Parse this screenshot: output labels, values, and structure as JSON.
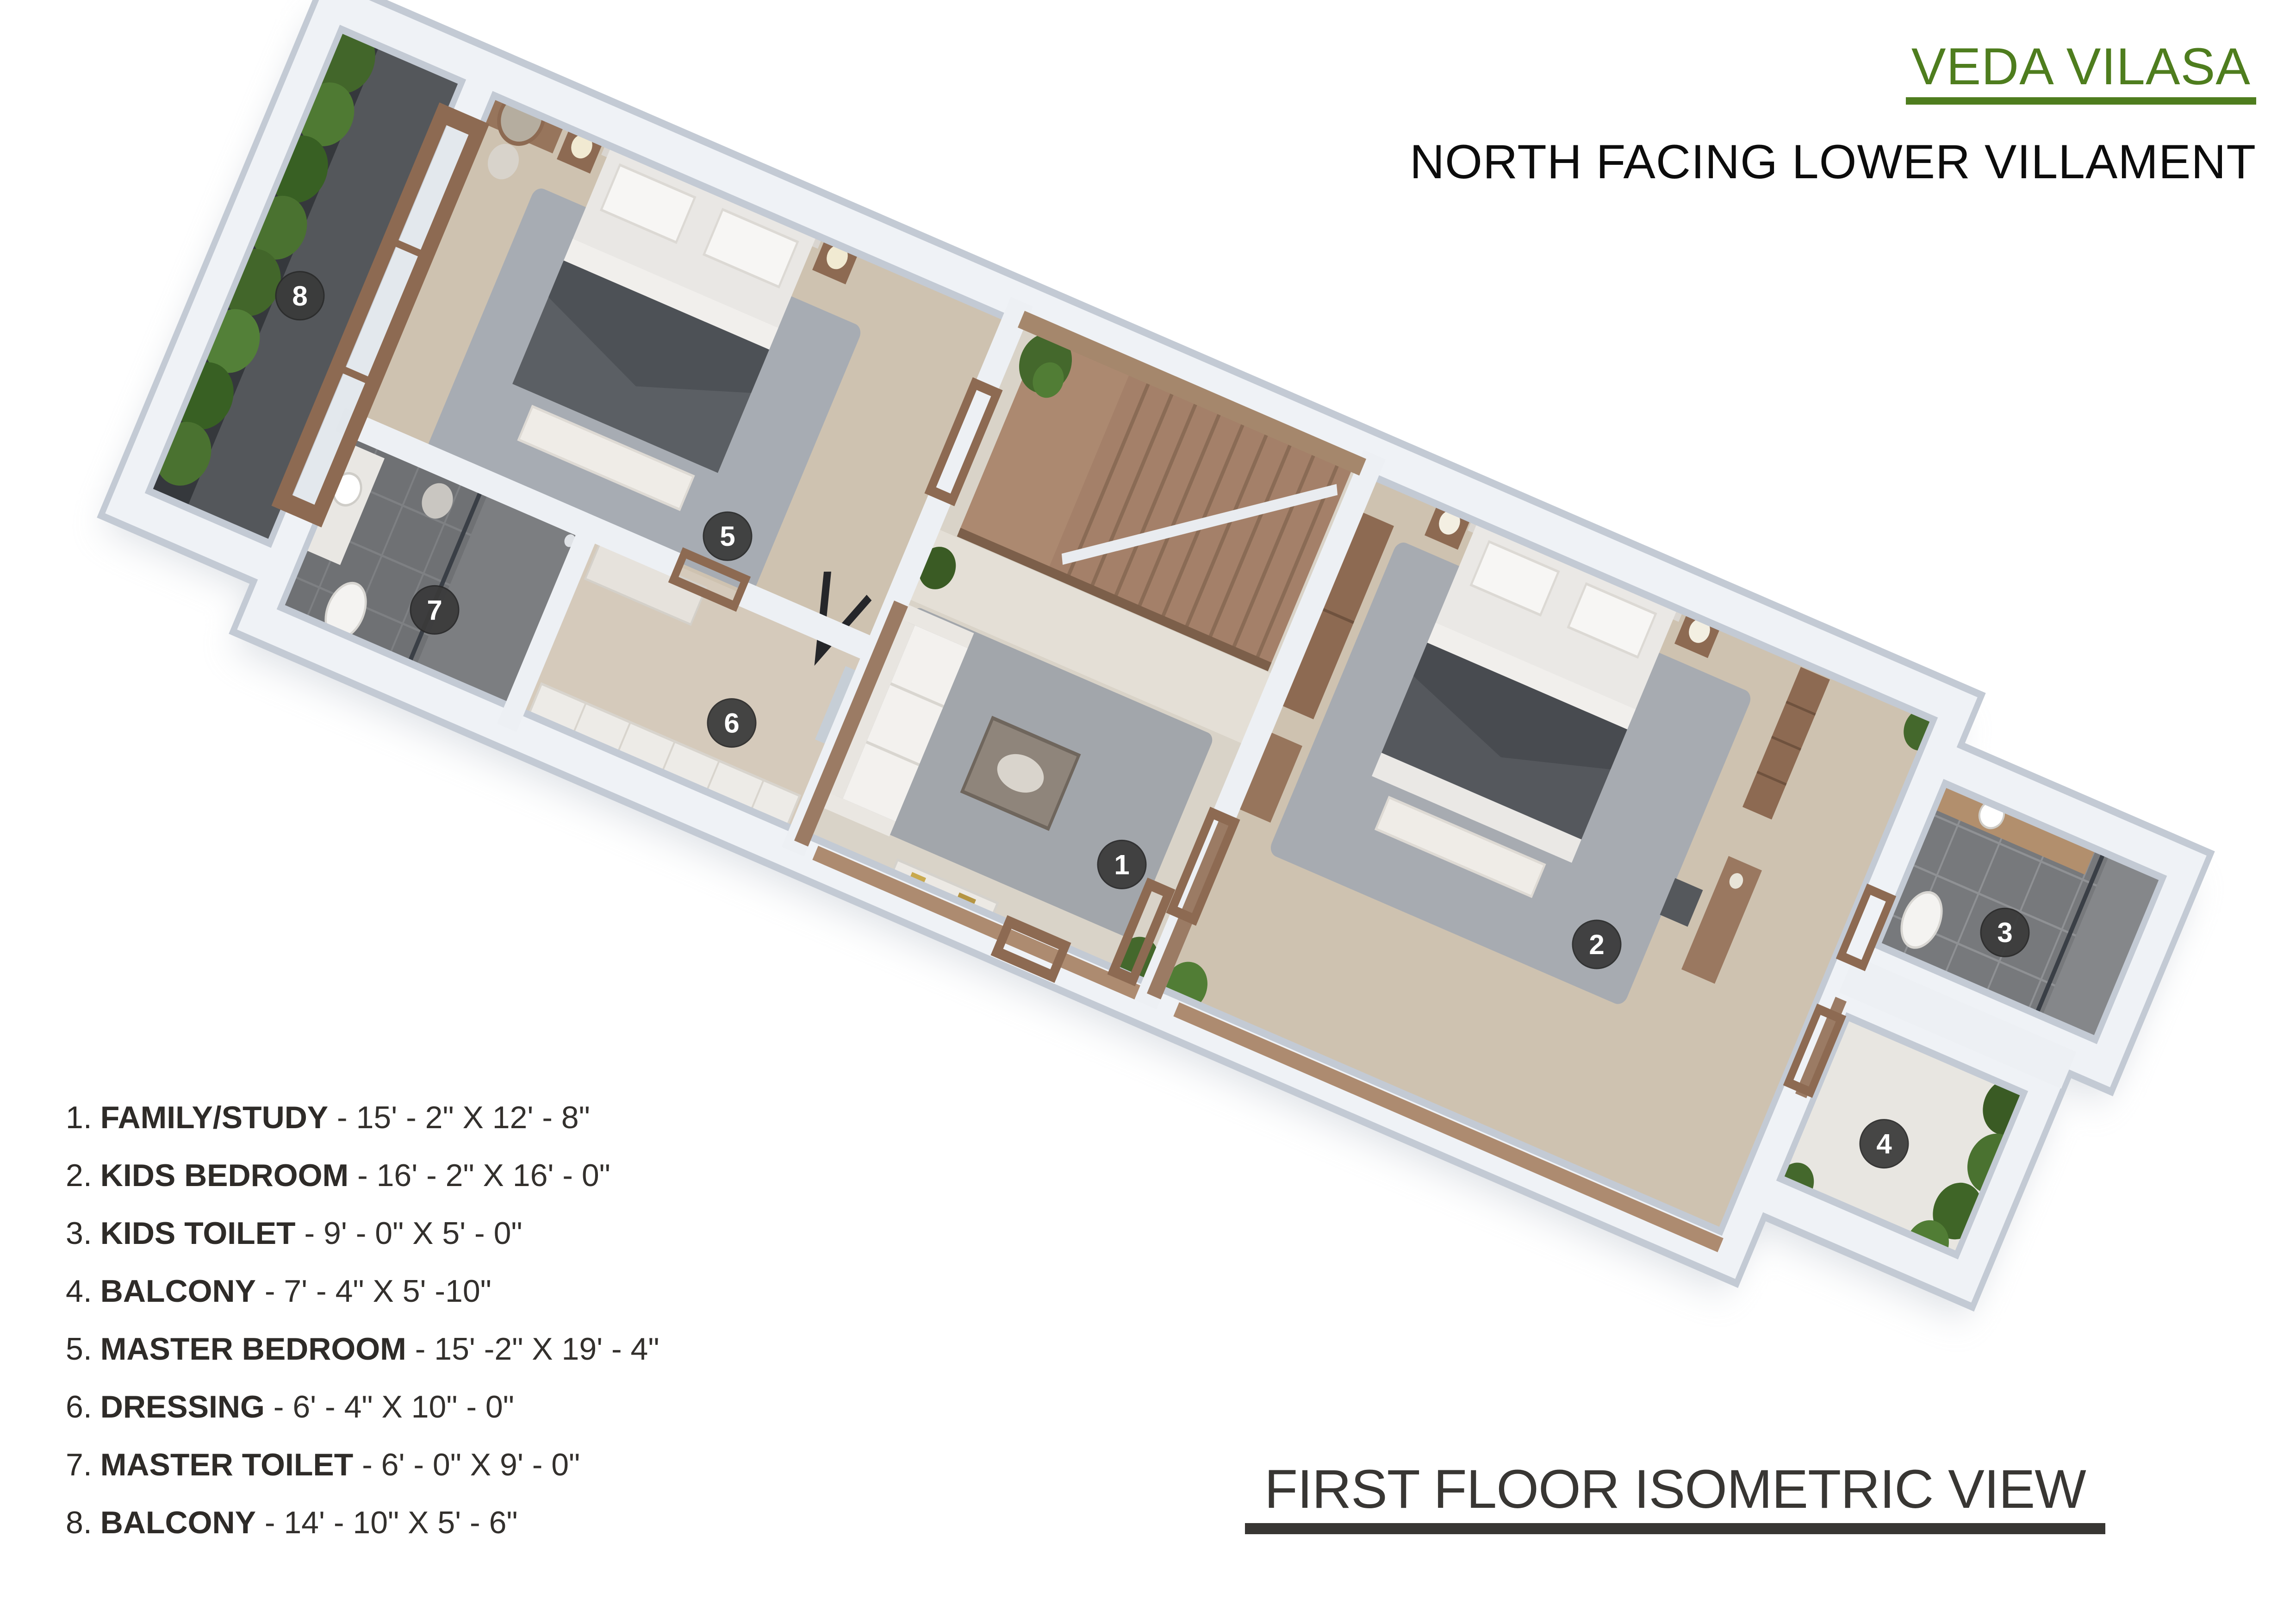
{
  "header": {
    "title": "VEDA VILASA",
    "subtitle": "NORTH FACING LOWER VILLAMENT",
    "title_color": "#4e7d1e"
  },
  "caption": {
    "text": "FIRST FLOOR ISOMETRIC VIEW"
  },
  "legend": {
    "items": [
      {
        "num": "1.",
        "name": "FAMILY/STUDY",
        "dims": "- 15' - 2\" X 12' - 8\""
      },
      {
        "num": "2.",
        "name": "KIDS BEDROOM",
        "dims": "- 16' - 2\" X 16' - 0\""
      },
      {
        "num": "3.",
        "name": "KIDS TOILET",
        "dims": "- 9' - 0\" X 5' - 0\""
      },
      {
        "num": "4.",
        "name": "BALCONY",
        "dims": "- 7' - 4\" X 5' -10\""
      },
      {
        "num": "5.",
        "name": "MASTER BEDROOM",
        "dims": "- 15' -2\" X 19' - 4\""
      },
      {
        "num": "6.",
        "name": "DRESSING",
        "dims": "- 6' - 4\" X 10\" - 0\""
      },
      {
        "num": "7.",
        "name": "MASTER TOILET",
        "dims": "- 6' - 0\" X 9' - 0\""
      },
      {
        "num": "8.",
        "name": "BALCONY",
        "dims": "- 14' - 10\" X 5' - 6\""
      }
    ]
  },
  "plan": {
    "marker_color": "#3a3a3a",
    "marker_text_color": "#ffffff",
    "markers": [
      {
        "label": "1",
        "u": 29.5,
        "v": 13.2
      },
      {
        "label": "2",
        "u": 45.0,
        "v": 10.0
      },
      {
        "label": "3",
        "u": 57.3,
        "v": 5.2
      },
      {
        "label": "4",
        "u": 56.3,
        "v": 11.9
      },
      {
        "label": "5",
        "u": 13.3,
        "v": 9.2
      },
      {
        "label": "6",
        "u": 15.8,
        "v": 13.9
      },
      {
        "label": "7",
        "u": 5.3,
        "v": 14.3
      },
      {
        "label": "8",
        "u": -2.8,
        "v": 7.8
      }
    ]
  }
}
